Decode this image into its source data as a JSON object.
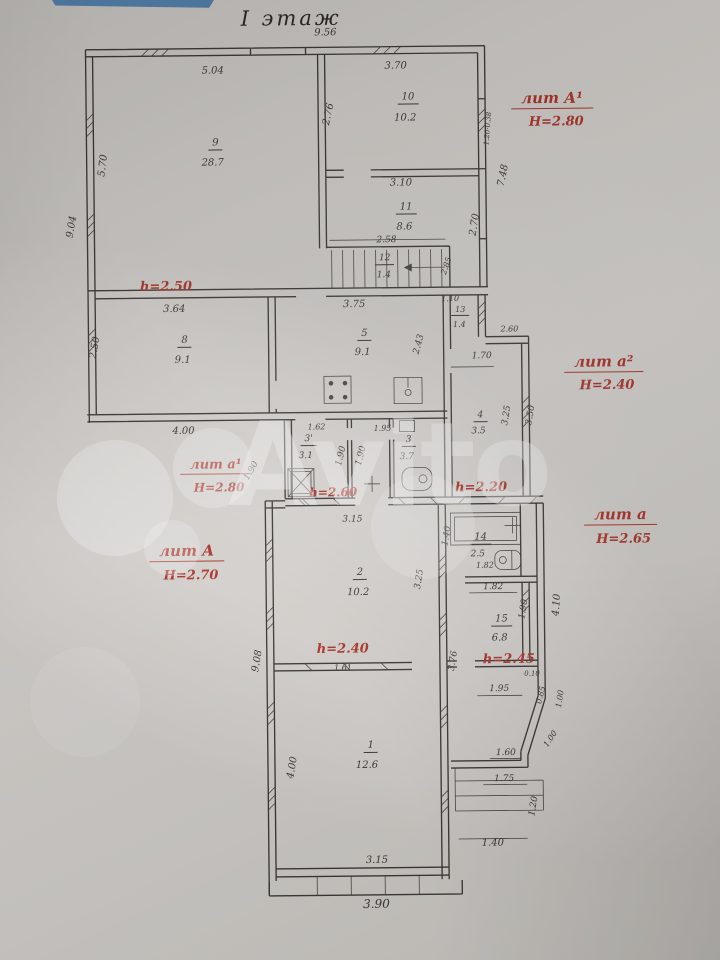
{
  "title": "I этаж",
  "watermark": "Avito",
  "colors": {
    "paper": "#d8d5d0",
    "ink": "#3e3b38",
    "red": "#b2372e",
    "blue": "#4d7fae"
  },
  "labels": [
    {
      "t": "I этаж",
      "x": 296,
      "y": 18,
      "c": "title"
    },
    {
      "t": "9.56",
      "x": 330,
      "y": 33,
      "c": "dim"
    },
    {
      "t": "5.04",
      "x": 217,
      "y": 70,
      "c": "dim"
    },
    {
      "t": "3.70",
      "x": 400,
      "y": 67,
      "c": "dim"
    },
    {
      "t": "5.70",
      "x": 107,
      "y": 163,
      "c": "dim",
      "r": -82
    },
    {
      "t": "9.04",
      "x": 75,
      "y": 224,
      "c": "dim",
      "r": -80
    },
    {
      "t": "2.76",
      "x": 333,
      "y": 114,
      "c": "dim",
      "r": -78
    },
    {
      "t": "9",
      "x": 219,
      "y": 143,
      "c": "num"
    },
    {
      "t": "28.7",
      "x": 216,
      "y": 162,
      "c": "area"
    },
    {
      "t": "10",
      "x": 412,
      "y": 99,
      "c": "num"
    },
    {
      "t": "10.2",
      "x": 409,
      "y": 119,
      "c": "area"
    },
    {
      "t": "3.10",
      "x": 404,
      "y": 184,
      "c": "dim"
    },
    {
      "t": "11",
      "x": 409,
      "y": 209,
      "c": "num"
    },
    {
      "t": "8.6",
      "x": 407,
      "y": 228,
      "c": "area"
    },
    {
      "t": "2.70",
      "x": 478,
      "y": 226,
      "c": "dim",
      "r": -80
    },
    {
      "t": "7.48",
      "x": 507,
      "y": 177,
      "c": "dim",
      "r": -78
    },
    {
      "t": "1.20·0.38",
      "x": 492,
      "y": 130,
      "c": "dim",
      "r": -85,
      "fs": 7
    },
    {
      "t": "2.58",
      "x": 389,
      "y": 241,
      "c": "dim",
      "fs": 9
    },
    {
      "t": "12",
      "x": 387,
      "y": 260,
      "c": "num",
      "fs": 9
    },
    {
      "t": "1.4",
      "x": 386,
      "y": 276,
      "c": "area",
      "fs": 9
    },
    {
      "t": "2.85",
      "x": 449,
      "y": 267,
      "c": "dim",
      "r": -70,
      "fs": 8
    },
    {
      "t": "1.10",
      "x": 452,
      "y": 300,
      "c": "dim",
      "fs": 8
    },
    {
      "t": "13",
      "x": 462,
      "y": 312,
      "c": "num",
      "fs": 8
    },
    {
      "t": "1.4",
      "x": 461,
      "y": 326,
      "c": "area",
      "fs": 8
    },
    {
      "t": "3.64",
      "x": 176,
      "y": 308,
      "c": "dim"
    },
    {
      "t": "3.75",
      "x": 356,
      "y": 305,
      "c": "dim"
    },
    {
      "t": "2.50",
      "x": 97,
      "y": 345,
      "c": "dim",
      "r": -80
    },
    {
      "t": "8",
      "x": 186,
      "y": 340,
      "c": "num"
    },
    {
      "t": "9.1",
      "x": 184,
      "y": 359,
      "c": "area"
    },
    {
      "t": "5",
      "x": 366,
      "y": 335,
      "c": "num"
    },
    {
      "t": "9.1",
      "x": 364,
      "y": 353,
      "c": "area"
    },
    {
      "t": "2.43",
      "x": 421,
      "y": 345,
      "c": "dim",
      "r": -75,
      "fs": 9
    },
    {
      "t": "4.00",
      "x": 184,
      "y": 430,
      "c": "dim"
    },
    {
      "t": "1.62",
      "x": 317,
      "y": 427,
      "c": "dim",
      "fs": 8
    },
    {
      "t": "1.95",
      "x": 383,
      "y": 429,
      "c": "dim",
      "fs": 8
    },
    {
      "t": "2.60",
      "x": 511,
      "y": 331,
      "c": "dim",
      "fs": 8
    },
    {
      "t": "1.70",
      "x": 483,
      "y": 358,
      "c": "dim",
      "fs": 9
    },
    {
      "t": "3.25",
      "x": 508,
      "y": 417,
      "c": "dim",
      "r": -80,
      "fs": 9
    },
    {
      "t": "3.50",
      "x": 532,
      "y": 417,
      "c": "dim",
      "r": -80,
      "fs": 9
    },
    {
      "t": "4",
      "x": 481,
      "y": 418,
      "c": "num",
      "fs": 9
    },
    {
      "t": "3.5",
      "x": 479,
      "y": 433,
      "c": "area",
      "fs": 9
    },
    {
      "t": "3'",
      "x": 309,
      "y": 440,
      "c": "num",
      "fs": 9
    },
    {
      "t": "3.1",
      "x": 306,
      "y": 456,
      "c": "area",
      "fs": 9
    },
    {
      "t": "1.90",
      "x": 342,
      "y": 456,
      "c": "dim",
      "r": -75,
      "fs": 9
    },
    {
      "t": "1.90",
      "x": 362,
      "y": 456,
      "c": "dim",
      "r": -75,
      "fs": 9
    },
    {
      "t": "3",
      "x": 409,
      "y": 442,
      "c": "num",
      "fs": 9
    },
    {
      "t": "3.7",
      "x": 407,
      "y": 458,
      "c": "area",
      "fs": 9
    },
    {
      "t": "1.90",
      "x": 252,
      "y": 470,
      "c": "dim",
      "r": -60,
      "fs": 9
    },
    {
      "t": "1.40",
      "x": 447,
      "y": 537,
      "c": "dim",
      "r": -80,
      "fs": 9
    },
    {
      "t": "14",
      "x": 480,
      "y": 540,
      "c": "num"
    },
    {
      "t": "2.5",
      "x": 477,
      "y": 556,
      "c": "area",
      "fs": 9
    },
    {
      "t": "1.82",
      "x": 484,
      "y": 567,
      "c": "dim",
      "fs": 8
    },
    {
      "t": "1.82",
      "x": 492,
      "y": 589,
      "c": "dim",
      "fs": 9
    },
    {
      "t": "15",
      "x": 500,
      "y": 622,
      "c": "num"
    },
    {
      "t": "6.8",
      "x": 498,
      "y": 640,
      "c": "area"
    },
    {
      "t": "1.90",
      "x": 523,
      "y": 611,
      "c": "dim",
      "r": -80,
      "fs": 9
    },
    {
      "t": "4.10",
      "x": 556,
      "y": 607,
      "c": "dim",
      "r": -85,
      "fs": 10
    },
    {
      "t": "3.76",
      "x": 452,
      "y": 662,
      "c": "dim",
      "r": -80,
      "fs": 9
    },
    {
      "t": "1.95",
      "x": 497,
      "y": 691,
      "c": "dim",
      "fs": 9
    },
    {
      "t": "0.10",
      "x": 530,
      "y": 676,
      "c": "dim",
      "fs": 7
    },
    {
      "t": "0.85",
      "x": 539,
      "y": 697,
      "c": "dim",
      "r": -75,
      "fs": 8
    },
    {
      "t": "1.00",
      "x": 558,
      "y": 701,
      "c": "dim",
      "r": -80,
      "fs": 8
    },
    {
      "t": "1.00",
      "x": 548,
      "y": 741,
      "c": "dim",
      "r": -55,
      "fs": 8
    },
    {
      "t": "1.60",
      "x": 503,
      "y": 755,
      "c": "dim",
      "fs": 9
    },
    {
      "t": "1.75",
      "x": 501,
      "y": 781,
      "c": "dim",
      "fs": 9
    },
    {
      "t": "1.20",
      "x": 531,
      "y": 808,
      "c": "dim",
      "r": -80,
      "fs": 9
    },
    {
      "t": "1.40",
      "x": 489,
      "y": 845,
      "c": "dim"
    },
    {
      "t": "3.15",
      "x": 352,
      "y": 520,
      "c": "dim",
      "fs": 9
    },
    {
      "t": "2",
      "x": 359,
      "y": 574,
      "c": "num"
    },
    {
      "t": "10.2",
      "x": 357,
      "y": 593,
      "c": "area"
    },
    {
      "t": "3.25",
      "x": 419,
      "y": 580,
      "c": "dim",
      "r": -80,
      "fs": 9
    },
    {
      "t": "1.61",
      "x": 341,
      "y": 668,
      "c": "dim",
      "fs": 8
    },
    {
      "t": "9.08",
      "x": 256,
      "y": 660,
      "c": "dim",
      "r": -80
    },
    {
      "t": "1",
      "x": 368,
      "y": 747,
      "c": "num"
    },
    {
      "t": "12.6",
      "x": 364,
      "y": 766,
      "c": "area"
    },
    {
      "t": "4.00",
      "x": 290,
      "y": 767,
      "c": "dim",
      "r": -80
    },
    {
      "t": "3.15",
      "x": 373,
      "y": 861,
      "c": "dim"
    },
    {
      "t": "3.90",
      "x": 372,
      "y": 904,
      "c": "dim",
      "fs": 12
    },
    {
      "t": "h=2.50",
      "x": 168,
      "y": 285,
      "c": "red"
    },
    {
      "t": "лит А¹",
      "x": 556,
      "y": 102,
      "c": "redu"
    },
    {
      "t": "Н=2.80",
      "x": 560,
      "y": 124,
      "c": "redsub"
    },
    {
      "t": "лит а²",
      "x": 605,
      "y": 366,
      "c": "redu"
    },
    {
      "t": "Н=2.40",
      "x": 608,
      "y": 388,
      "c": "redsub"
    },
    {
      "t": "лит а¹",
      "x": 216,
      "y": 465,
      "c": "redu",
      "fs": 13
    },
    {
      "t": "Н=2.80",
      "x": 219,
      "y": 486,
      "c": "redsub",
      "fs": 12
    },
    {
      "t": "h=2.60",
      "x": 333,
      "y": 492,
      "c": "red",
      "fs": 12
    },
    {
      "t": "h=2.20",
      "x": 481,
      "y": 489,
      "c": "red"
    },
    {
      "t": "лит А",
      "x": 186,
      "y": 551,
      "c": "redu"
    },
    {
      "t": "Н=2.70",
      "x": 190,
      "y": 574,
      "c": "redsub"
    },
    {
      "t": "лит а",
      "x": 620,
      "y": 519,
      "c": "redu"
    },
    {
      "t": "Н=2.65",
      "x": 623,
      "y": 542,
      "c": "redsub"
    },
    {
      "t": "h=2.40",
      "x": 341,
      "y": 649,
      "c": "red"
    },
    {
      "t": "h=2.45",
      "x": 507,
      "y": 661,
      "c": "red"
    }
  ]
}
